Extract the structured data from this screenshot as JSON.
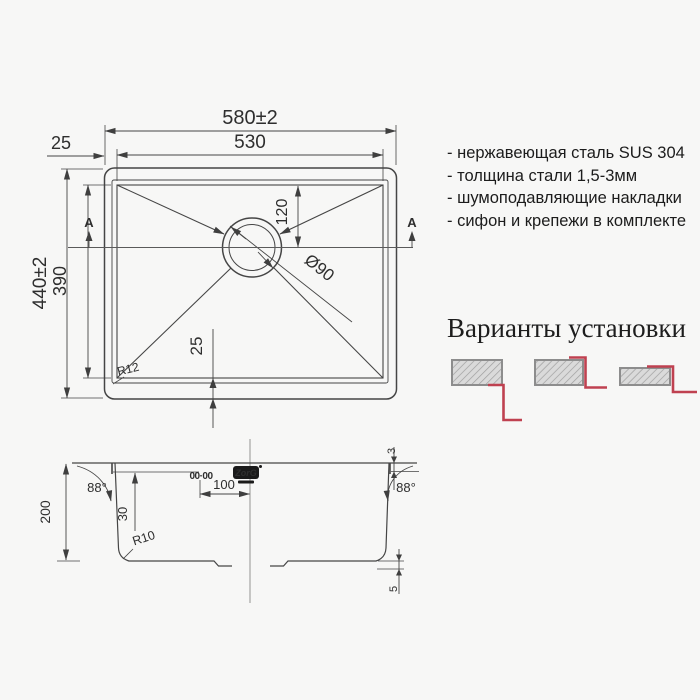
{
  "specs": {
    "items": [
      "- нержавеющая сталь SUS 304",
      "- толщина стали 1,5-3мм",
      "- шумоподавляющие накладки",
      "- сифон и крепежи в комплекте"
    ]
  },
  "install": {
    "title": "Варианты установки"
  },
  "top_view": {
    "width_outer": "580±2",
    "width_inner": "530",
    "rim_left": "25",
    "height_outer": "440±2",
    "height_inner": "390",
    "drain_offset": "120",
    "drain_diameter": "Ø90",
    "bottom_offset": "25",
    "corner_radius": "R12",
    "section_label": "A"
  },
  "section_view": {
    "depth": "200",
    "angle_left": "88°",
    "angle_right": "88°",
    "dim_30": "30",
    "dim_100": "100",
    "rim_height": "3",
    "bottom_step": "5",
    "bottom_radius": "R10"
  },
  "brand": {
    "logo": "ZorG",
    "stamp": "00·00"
  },
  "colors": {
    "accent_red": "#bf4150",
    "line": "#454545",
    "hatch_fill": "#dadada"
  }
}
